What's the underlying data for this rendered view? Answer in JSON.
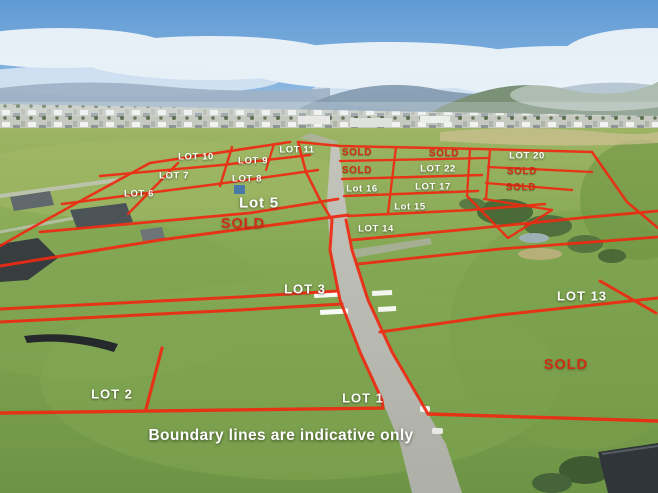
{
  "meta": {
    "description": "Aerial photograph of a rural land subdivision with red indicative lot boundary lines",
    "disclaimer_text": "Boundary lines are indicative only"
  },
  "colors": {
    "boundary_red": "#ee2a12",
    "sold_red": "#ce2e14",
    "label_white": "#fdfdfa",
    "sky_top": "#5f9ad4",
    "grass_green": "#7ba04e",
    "road_grey": "#b7b8b0"
  },
  "overlay": {
    "disclaimer": {
      "text": "Boundary lines are indicative only",
      "x": 281,
      "y": 436
    },
    "labels": [
      {
        "name": "lot-10-label",
        "text": "LOT 10",
        "x": 196,
        "y": 157,
        "style": "lot-small"
      },
      {
        "name": "lot-9-label",
        "text": "LOT 9",
        "x": 253,
        "y": 161,
        "style": "lot-small"
      },
      {
        "name": "lot-11-label",
        "text": "LOT 11",
        "x": 297,
        "y": 150,
        "style": "lot-small"
      },
      {
        "name": "lot-7-label",
        "text": "LOT 7",
        "x": 174,
        "y": 176,
        "style": "lot-small"
      },
      {
        "name": "lot-8-label",
        "text": "LOT 8",
        "x": 247,
        "y": 179,
        "style": "lot-small"
      },
      {
        "name": "lot-6-label",
        "text": "LOT 6",
        "x": 139,
        "y": 194,
        "style": "lot-small"
      },
      {
        "name": "lot-5-label",
        "text": "Lot 5",
        "x": 259,
        "y": 203,
        "style": "lot-large"
      },
      {
        "name": "sold-label-left",
        "text": "SOLD",
        "x": 243,
        "y": 224,
        "style": "sold-large"
      },
      {
        "name": "sold-label-top-1",
        "text": "SOLD",
        "x": 357,
        "y": 153,
        "style": "sold-small"
      },
      {
        "name": "sold-label-top-2",
        "text": "SOLD",
        "x": 444,
        "y": 154,
        "style": "sold-small"
      },
      {
        "name": "sold-label-mid",
        "text": "SOLD",
        "x": 357,
        "y": 171,
        "style": "sold-small"
      },
      {
        "name": "lot-22-label",
        "text": "LOT 22",
        "x": 438,
        "y": 169,
        "style": "lot-small"
      },
      {
        "name": "lot-16-label",
        "text": "Lot 16",
        "x": 362,
        "y": 189,
        "style": "lot-small"
      },
      {
        "name": "lot-17-label",
        "text": "LOT 17",
        "x": 433,
        "y": 187,
        "style": "lot-small"
      },
      {
        "name": "lot-15-label",
        "text": "Lot 15",
        "x": 410,
        "y": 207,
        "style": "lot-small"
      },
      {
        "name": "lot-14-label",
        "text": "LOT 14",
        "x": 376,
        "y": 229,
        "style": "lot-small"
      },
      {
        "name": "lot-20-label",
        "text": "LOT 20",
        "x": 527,
        "y": 156,
        "style": "lot-small"
      },
      {
        "name": "sold-label-right-1",
        "text": "SOLD",
        "x": 522,
        "y": 172,
        "style": "sold-small"
      },
      {
        "name": "sold-label-right-2",
        "text": "SOLD",
        "x": 521,
        "y": 188,
        "style": "sold-small"
      },
      {
        "name": "lot-3-label",
        "text": "LOT 3",
        "x": 305,
        "y": 289,
        "style": "lot-mid"
      },
      {
        "name": "lot-13-label",
        "text": "LOT 13",
        "x": 582,
        "y": 296,
        "style": "lot-mid"
      },
      {
        "name": "sold-label-bottom-right",
        "text": "SOLD",
        "x": 566,
        "y": 365,
        "style": "sold-large"
      },
      {
        "name": "lot-2-label",
        "text": "LOT 2",
        "x": 112,
        "y": 394,
        "style": "lot-mid"
      },
      {
        "name": "lot-1-label",
        "text": "LOT 1",
        "x": 363,
        "y": 398,
        "style": "lot-mid"
      }
    ]
  }
}
